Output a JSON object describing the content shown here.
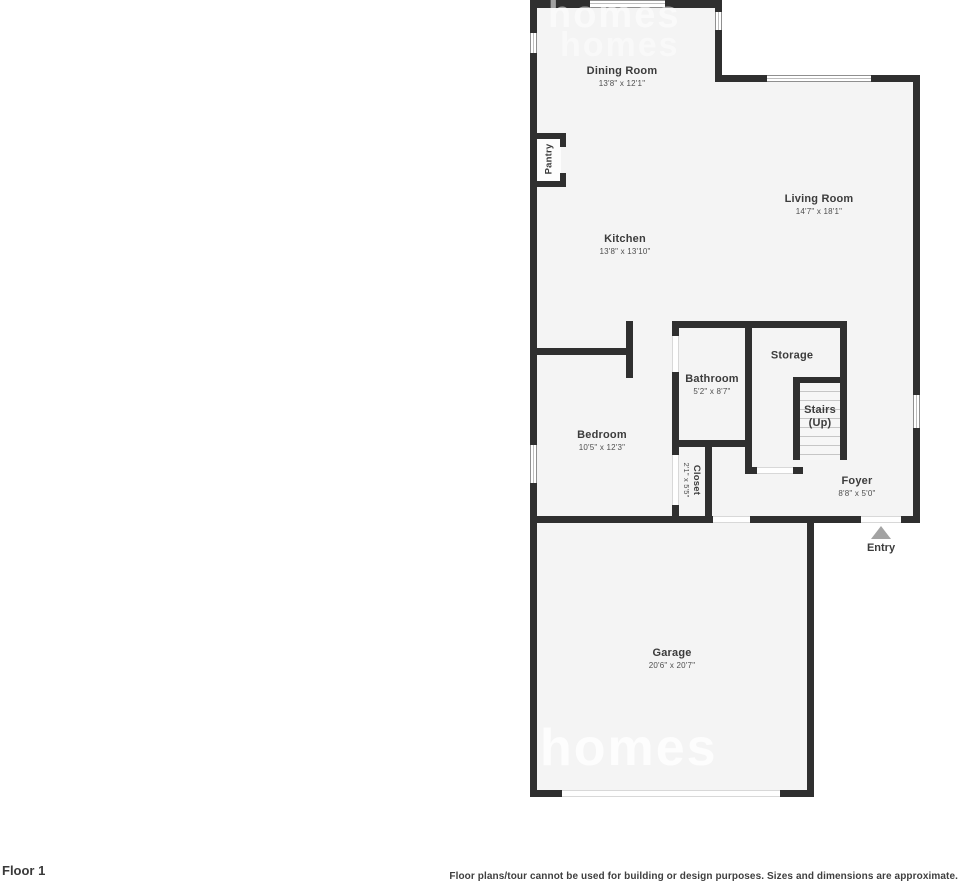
{
  "floor_plan": {
    "rooms": {
      "dining": {
        "name": "Dining Room",
        "dims": "13'8\" x 12'1\""
      },
      "pantry": {
        "name": "Pantry"
      },
      "kitchen": {
        "name": "Kitchen",
        "dims": "13'8\" x 13'10\""
      },
      "living": {
        "name": "Living Room",
        "dims": "14'7\" x 18'1\""
      },
      "bathroom": {
        "name": "Bathroom",
        "dims": "5'2\" x 8'7\""
      },
      "storage": {
        "name": "Storage"
      },
      "stairs": {
        "name": "Stairs",
        "sub": "(Up)"
      },
      "bedroom": {
        "name": "Bedroom",
        "dims": "10'5\" x 12'3\""
      },
      "closet": {
        "name": "Closet",
        "dims": "2'1\" x 5'5\""
      },
      "foyer": {
        "name": "Foyer",
        "dims": "8'8\" x 5'0\""
      },
      "garage": {
        "name": "Garage",
        "dims": "20'6\" x 20'7\""
      }
    },
    "entry_label": "Entry",
    "watermark": "homes",
    "colors": {
      "wall": "#2f2f2f",
      "floor": "#f4f4f4",
      "entry_arrow": "#a3a3a3"
    }
  },
  "footer": {
    "floor_label": "Floor 1",
    "disclaimer": "Floor plans/tour cannot be used for building or design purposes. Sizes and dimensions are approximate."
  }
}
